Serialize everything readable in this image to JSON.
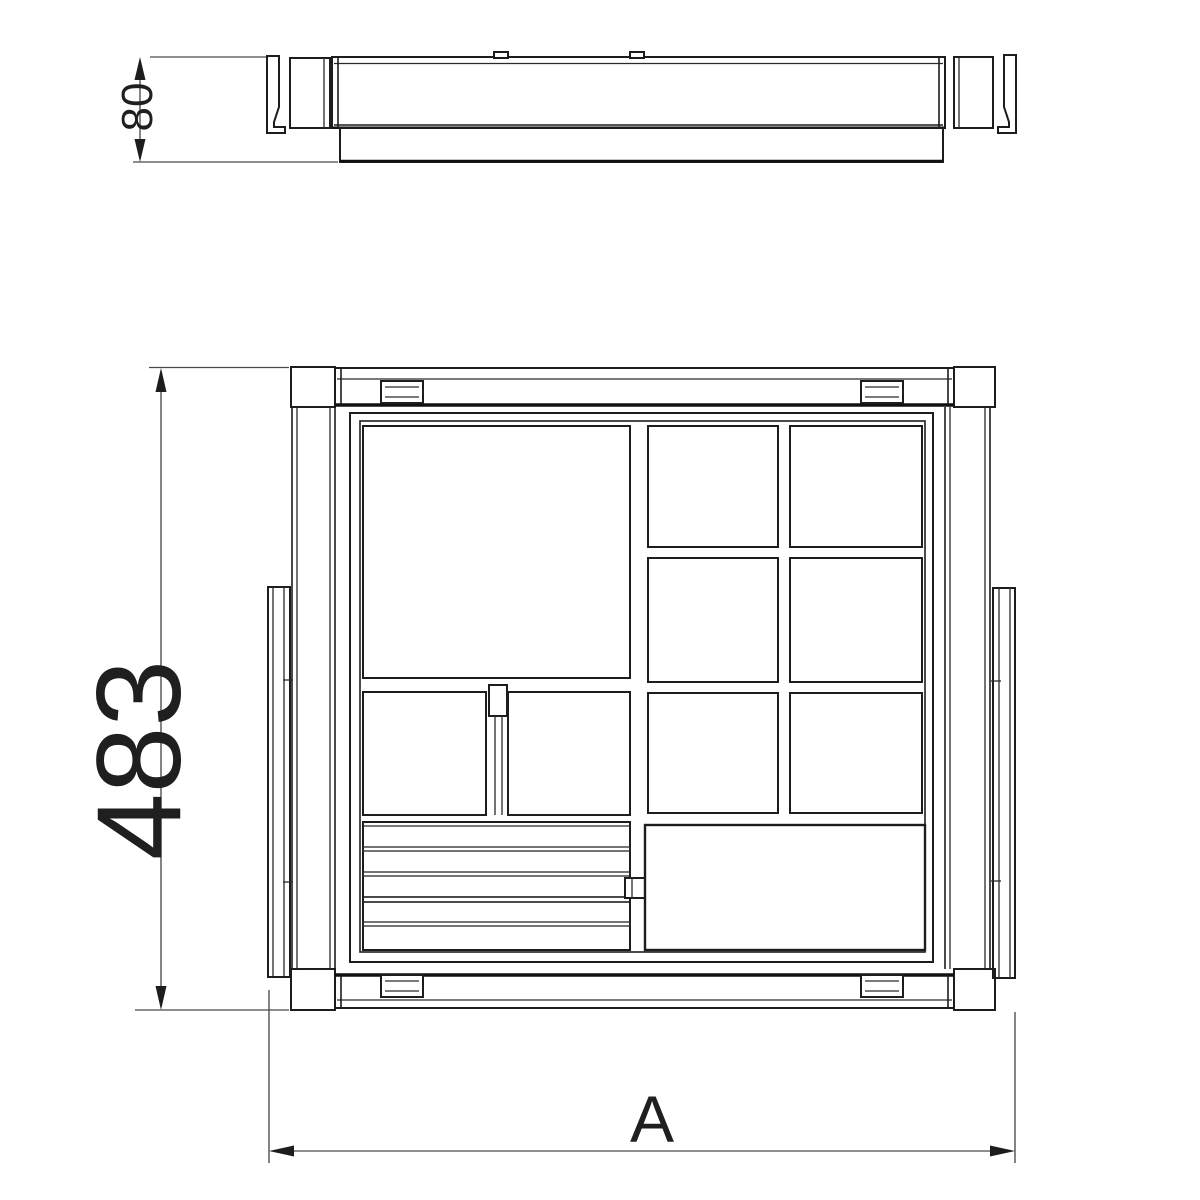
{
  "drawing": {
    "colors": {
      "background": "#ffffff",
      "line": "#1d1d1d",
      "dimension_line": "#4a4a4a"
    },
    "dimensions": {
      "side_height": {
        "label": "80"
      },
      "plan_depth": {
        "label": "483"
      },
      "plan_width": {
        "label": "A"
      }
    }
  }
}
